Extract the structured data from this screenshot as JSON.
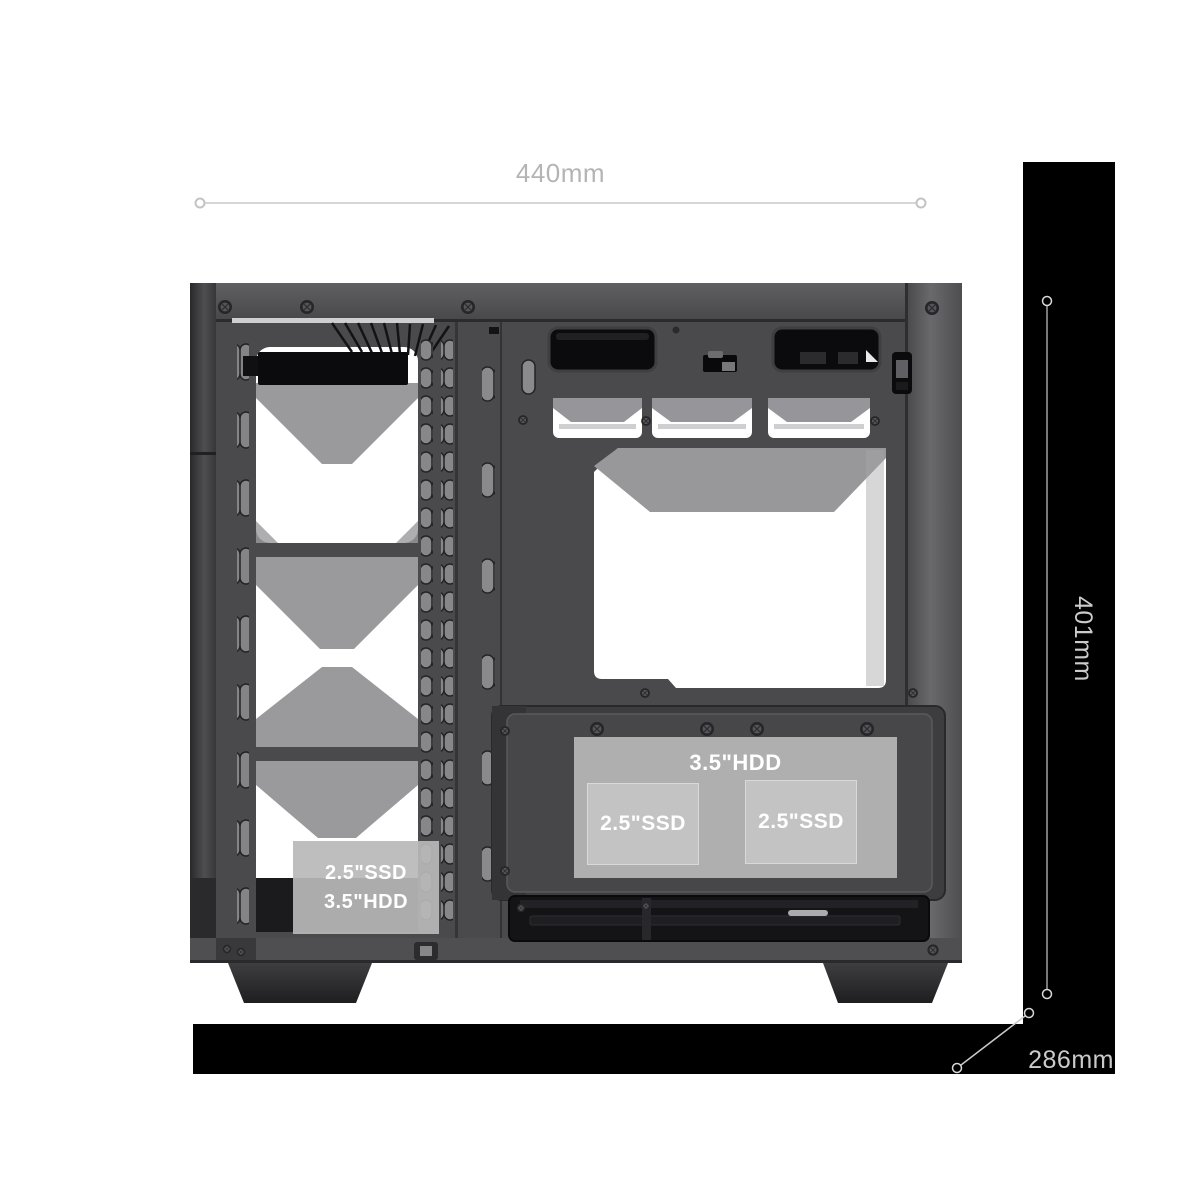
{
  "dimensions": {
    "width_label": "440mm",
    "height_label": "401mm",
    "depth_label": "286mm"
  },
  "drive_bays": {
    "hdd_cage_label": "3.5\"HDD",
    "ssd_left_label": "2.5\"SSD",
    "ssd_right_label": "2.5\"SSD",
    "front_bay_line1": "2.5\"SSD",
    "front_bay_line2": "3.5\"HDD"
  },
  "colors": {
    "background": "#ffffff",
    "annotation_gray": "#b4b4b4",
    "annotation_on_black": "#cbcbcb",
    "dimension_line": "#c9c9c9",
    "panel_black": "#000000",
    "case_gray": "#48484a",
    "overlay_gray": "#b9b9b9",
    "label_text": "#ffffff"
  }
}
